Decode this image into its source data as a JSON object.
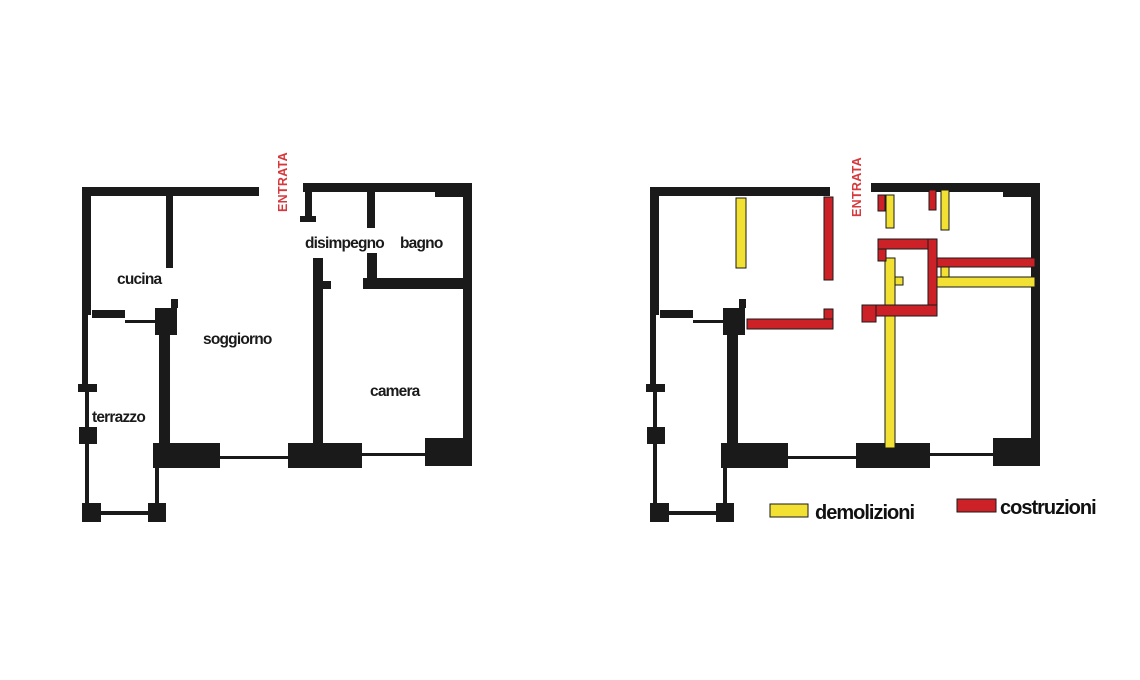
{
  "colors": {
    "background": "#FFFFFF",
    "wall": "#1A1A1A",
    "demolition": "#F2E132",
    "construction": "#CC2127",
    "entrance_text": "#D6393D"
  },
  "plans": {
    "left": {
      "entrance_label": "ENTRATA",
      "rooms": {
        "cucina": "cucina",
        "soggiorno": "soggiorno",
        "terrazzo": "terrazzo",
        "disimpegno": "disimpegno",
        "bagno": "bagno",
        "camera": "camera"
      }
    },
    "right": {
      "entrance_label": "ENTRATA",
      "demolitions": [
        [
          736,
          198,
          10,
          70
        ],
        [
          886,
          195,
          8,
          33
        ],
        [
          941,
          190,
          8,
          40
        ],
        [
          941,
          260,
          8,
          22
        ],
        [
          935,
          277,
          100,
          10
        ],
        [
          885,
          258,
          10,
          190
        ],
        [
          895,
          277,
          8,
          8
        ]
      ],
      "constructions": [
        [
          878,
          195,
          7,
          16
        ],
        [
          929,
          190,
          7,
          20
        ],
        [
          824,
          197,
          9,
          83
        ],
        [
          747,
          319,
          86,
          10
        ],
        [
          824,
          309,
          9,
          10
        ],
        [
          878,
          239,
          58,
          10
        ],
        [
          878,
          249,
          8,
          12
        ],
        [
          928,
          239,
          9,
          73
        ],
        [
          937,
          258,
          98,
          9
        ],
        [
          876,
          305,
          61,
          11
        ],
        [
          862,
          305,
          14,
          17
        ]
      ]
    }
  },
  "legend": {
    "items": [
      {
        "label": "demolizioni",
        "color": "#F2E132"
      },
      {
        "label": "costruzioni",
        "color": "#CC2127"
      }
    ]
  }
}
